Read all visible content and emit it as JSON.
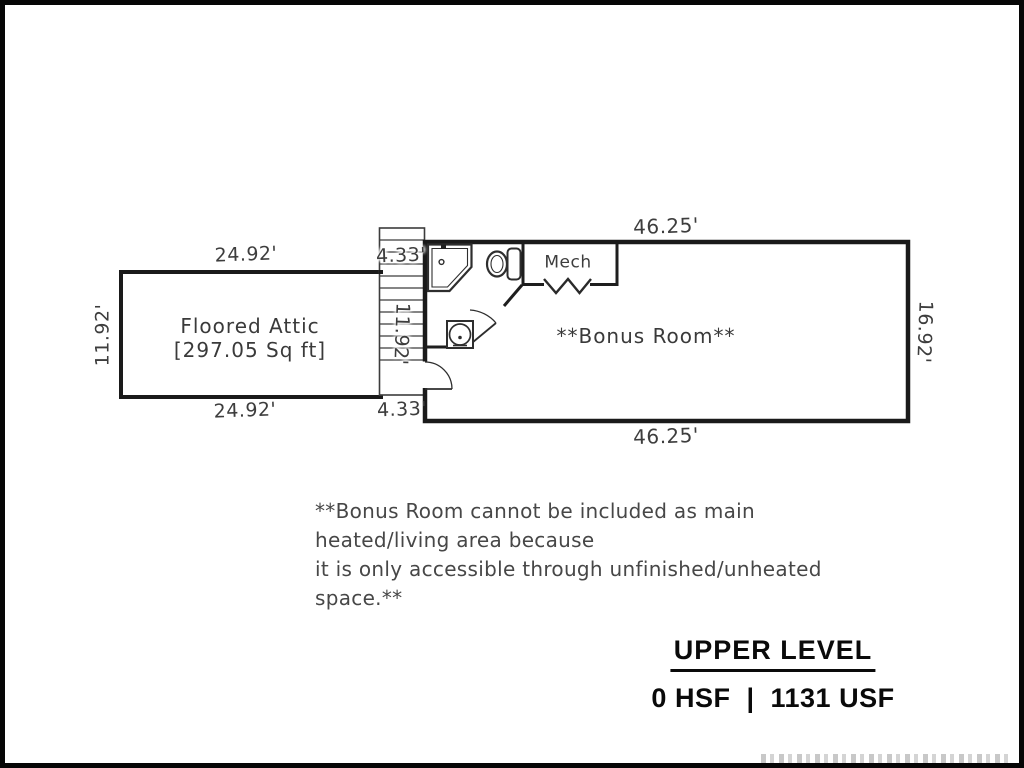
{
  "plan": {
    "attic": {
      "name": "Floored Attic",
      "area": "[297.05 Sq ft]",
      "dim_top": "24.92'",
      "dim_bottom": "24.92'",
      "dim_left": "11.92'"
    },
    "stairs": {
      "dim_top": "4.33'",
      "dim_bottom": "4.33'",
      "dim_height": "11.92'"
    },
    "bonus_room": {
      "label": "**Bonus Room**",
      "dim_top": "46.25'",
      "dim_bottom": "46.25'",
      "dim_right": "16.92'"
    },
    "mech_closet": {
      "label": "Mech"
    }
  },
  "note": {
    "line1": "**Bonus Room cannot be included as main heated/living area because",
    "line2": "it is only accessible through unfinished/unheated space.**"
  },
  "footer": {
    "level_title": "UPPER LEVEL",
    "area_summary": "0 HSF  |  1131 USF"
  },
  "colors": {
    "wall": "#1a1a1a",
    "fixture": "#2e2e2e",
    "label_text": "#3d3d3d",
    "frame": "#060606"
  }
}
